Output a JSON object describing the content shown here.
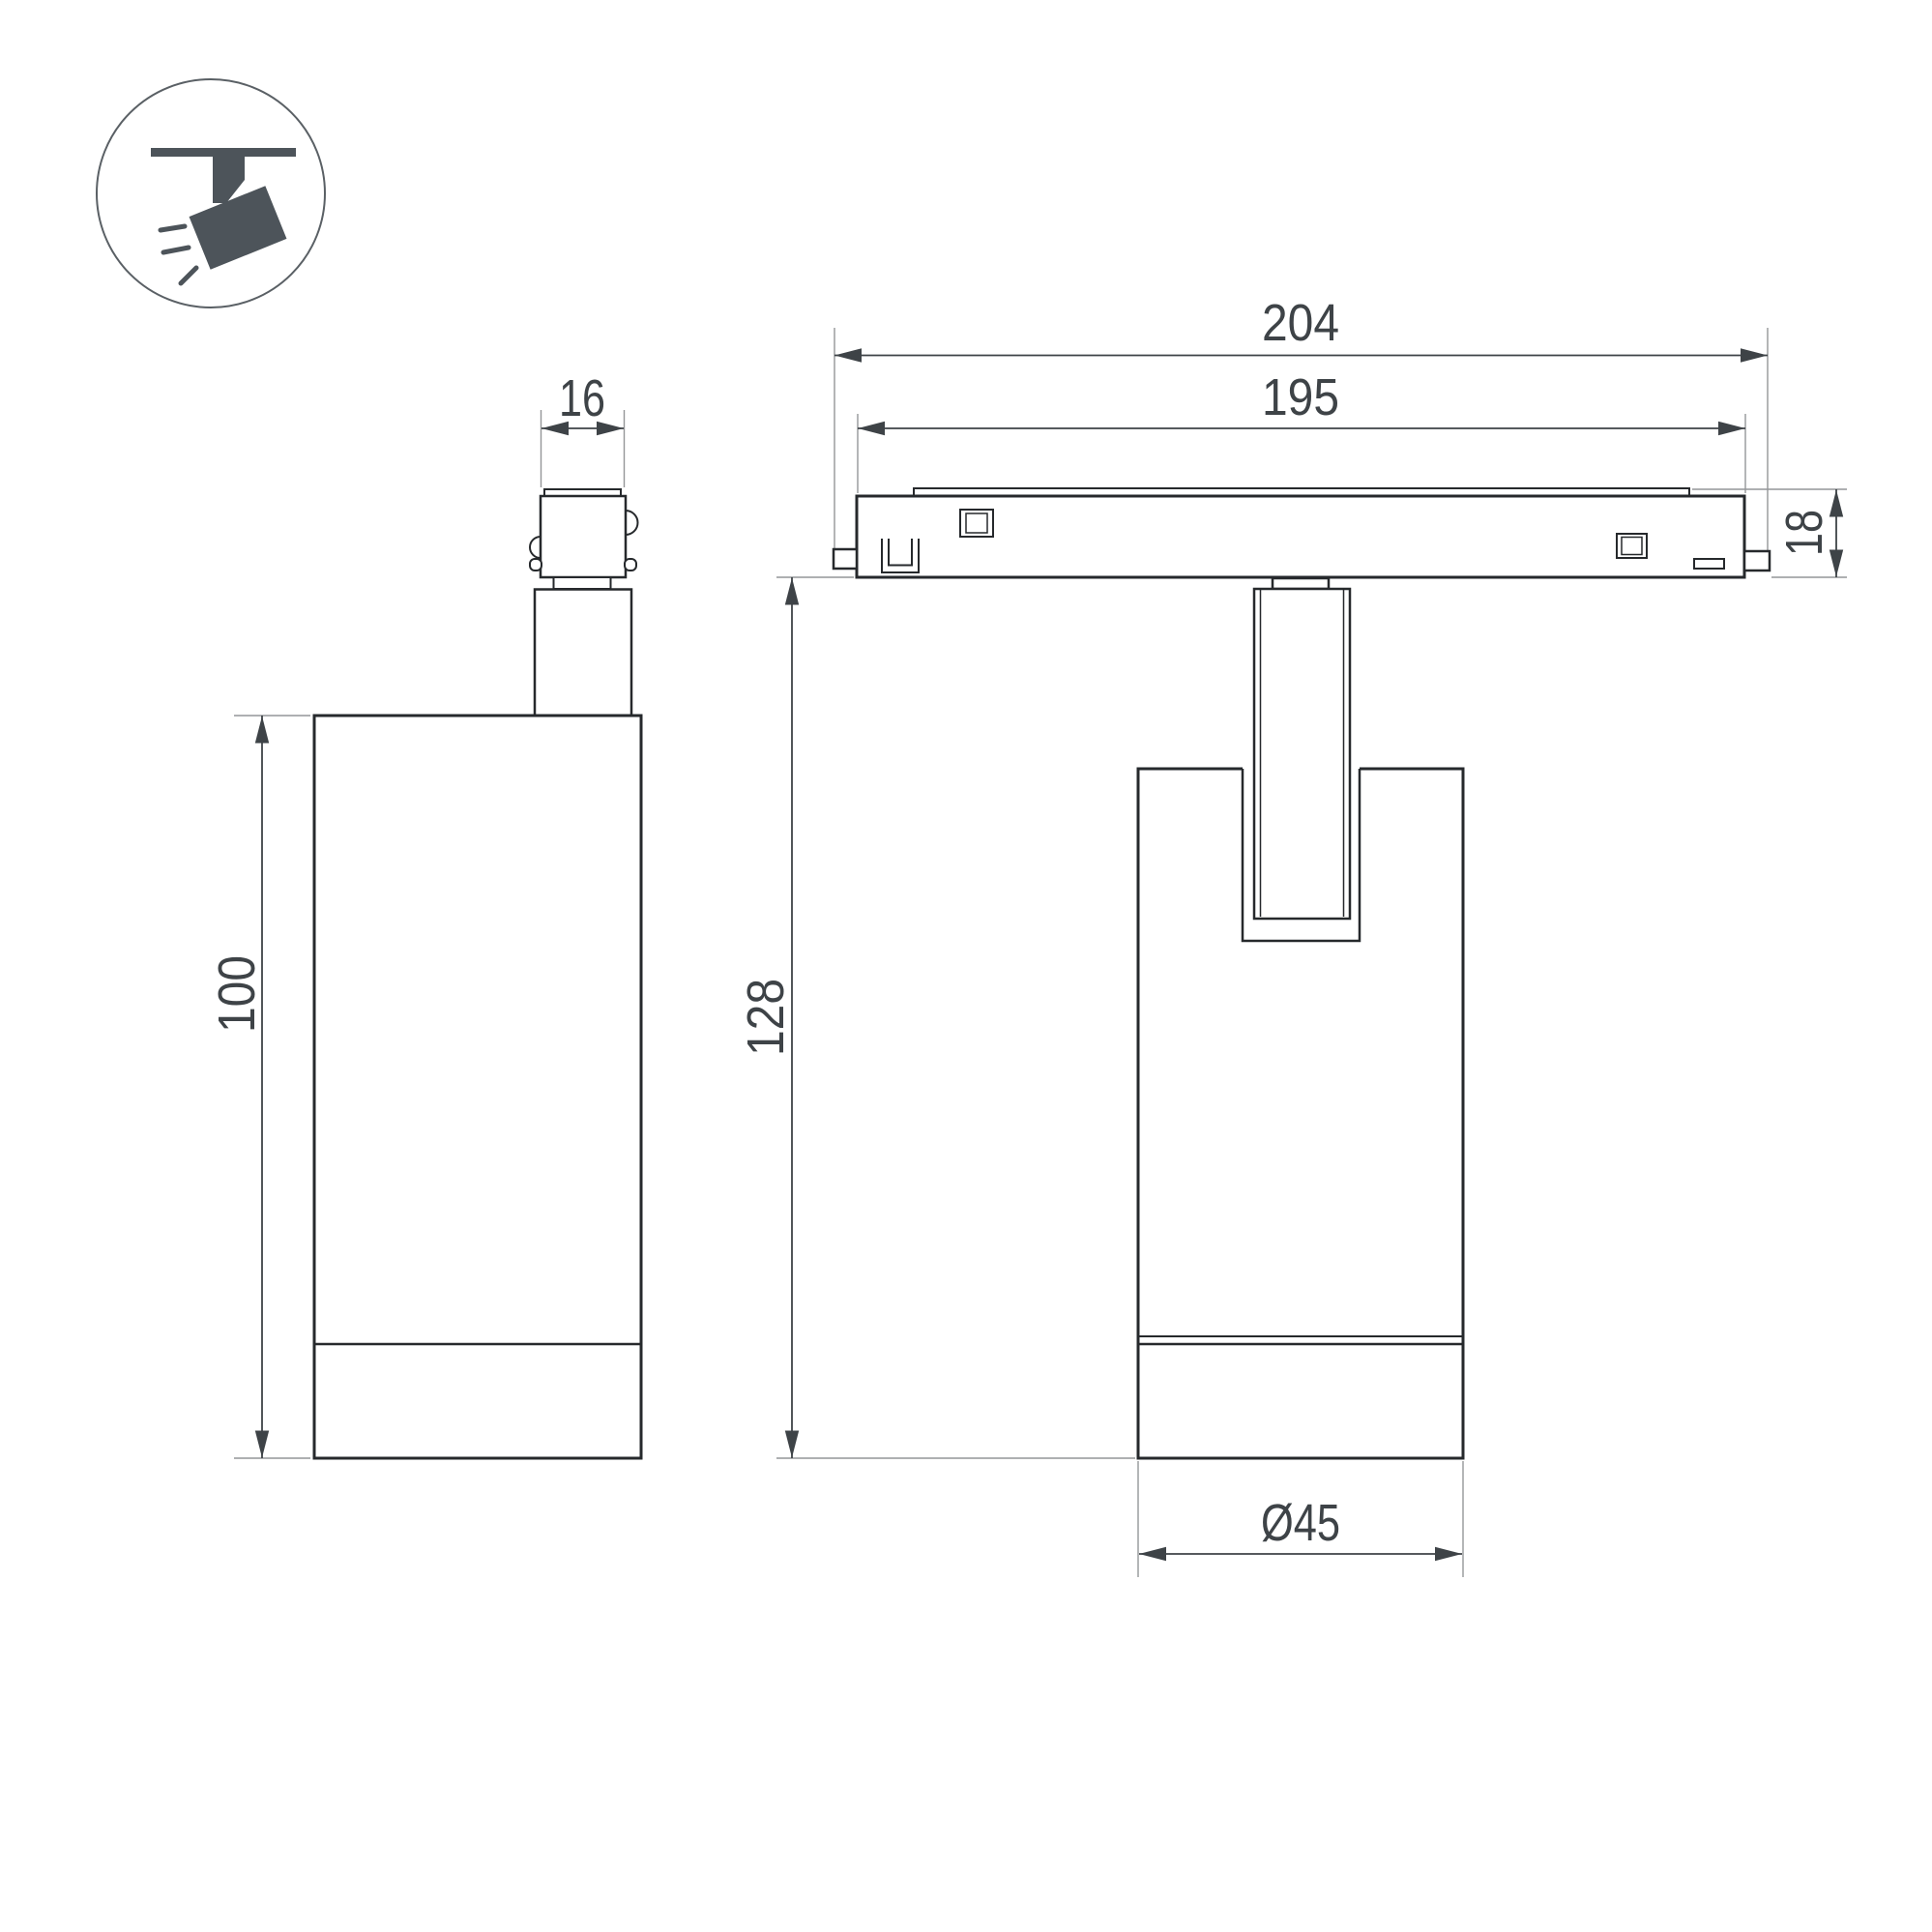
{
  "drawing": {
    "legend_icon": "ceiling-track-spotlight",
    "side_view": {
      "dim_connector_width": "16",
      "dim_body_height": "100"
    },
    "front_view": {
      "dim_track_overall_length": "204",
      "dim_track_body_length": "195",
      "dim_track_height": "18",
      "dim_overall_height": "128",
      "dim_body_diameter": "Ø45"
    }
  },
  "colors": {
    "outline": "#26292c",
    "dimension": "#3e4347",
    "extension": "#949698",
    "icon": "#4d545a",
    "background": "#ffffff"
  }
}
